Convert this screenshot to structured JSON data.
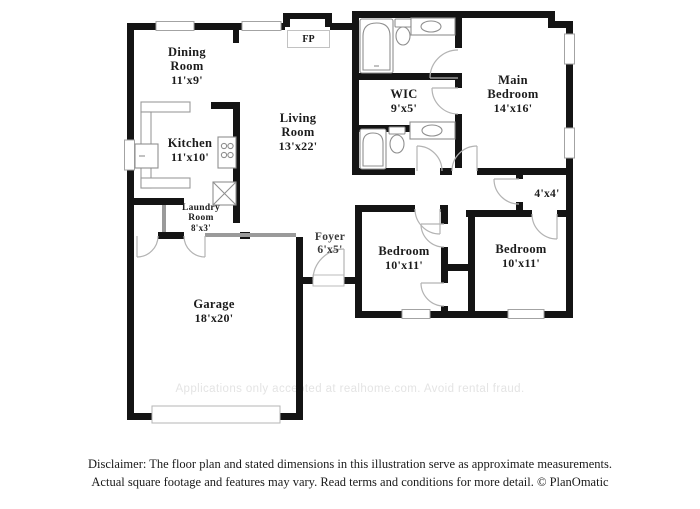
{
  "floor_plan": {
    "rooms": {
      "dining": {
        "name": "Dining Room",
        "dims": "11'x9'"
      },
      "kitchen": {
        "name": "Kitchen",
        "dims": "11'x10'"
      },
      "living": {
        "name": "Living Room",
        "dims": "13'x22'"
      },
      "laundry": {
        "name": "Laundry Room",
        "dims": "8'x3'"
      },
      "foyer": {
        "name": "Foyer",
        "dims": "6'x5'"
      },
      "garage": {
        "name": "Garage",
        "dims": "18'x20'"
      },
      "wic": {
        "name": "WIC",
        "dims": "9'x5'"
      },
      "main_bedroom": {
        "name": "Main Bedroom",
        "dims": "14'x16'"
      },
      "bedroom_left": {
        "name": "Bedroom",
        "dims": "10'x11'"
      },
      "bedroom_right": {
        "name": "Bedroom",
        "dims": "10'x11'"
      },
      "closet": {
        "dims": "4'x4'"
      }
    },
    "fireplace_label": "FP",
    "watermark": "Applications only accepted at realhome.com. Avoid rental fraud."
  },
  "footer": {
    "disclaimer_line1": "Disclaimer: The floor plan and stated dimensions in this illustration serve as approximate measurements.",
    "disclaimer_line2": "Actual square footage and features may vary. Read terms and conditions for more detail. © PlanOmatic"
  },
  "colors": {
    "wall": "#141414",
    "fixture_outline": "#8f8f8f",
    "door_arc": "#b3b3b3",
    "window_border": "#a3a3a3",
    "watermark": "#e4e4e4",
    "text": "#1c1c1c"
  }
}
